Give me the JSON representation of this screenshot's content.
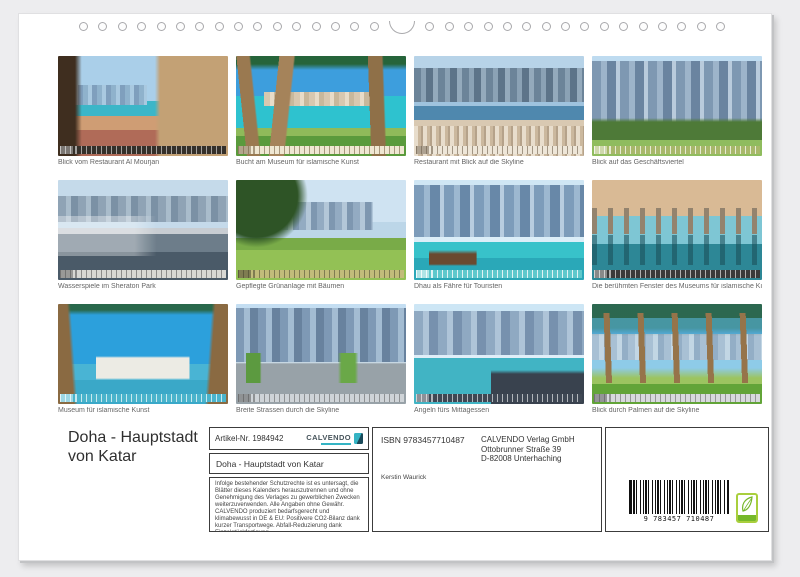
{
  "page": {
    "title_lines": [
      "Doha - Hauptstadt",
      "von Katar"
    ]
  },
  "thumbnails": [
    {
      "caption": "Blick vom Restaurant Al Mourjan"
    },
    {
      "caption": "Bucht am Museum für islamische Kunst"
    },
    {
      "caption": "Restaurant mit Blick auf die Skyline"
    },
    {
      "caption": "Blick auf das Geschäftsviertel"
    },
    {
      "caption": "Wasserspiele im Sheraton Park"
    },
    {
      "caption": "Gepflegte Grünanlage mit Bäumen"
    },
    {
      "caption": "Dhau als Fähre für Touristen"
    },
    {
      "caption": "Die berühmten Fenster des Museums für islamische Kunst"
    },
    {
      "caption": "Museum für islamische Kunst"
    },
    {
      "caption": "Breite Strassen durch die Skyline"
    },
    {
      "caption": "Angeln fürs Mittagessen"
    },
    {
      "caption": "Blick durch Palmen auf die Skyline"
    }
  ],
  "info": {
    "article_number": "Artikel-Nr. 1984942",
    "logo_brand": "CALVENDO",
    "product_title": "Doha - Hauptstadt von Katar",
    "legal_text": "Infolge bestehender Schutzrechte ist es untersagt, die Blätter dieses Kalenders herauszutrennen und ohne Genehmigung des Verlages zu gewerblichen Zwecken weiterzuverwenden. Alle Angaben ohne Gewähr. CALVENDO produziert bedarfsgerecht und klimabewusst in DE & EU: Positivere CO2-Bilanz dank kurzer Transportwege. Abfall-Reduzierung dank Einzelstückfertigung.",
    "contact_line": "E-Mail: info@calvendo.com • www.calvendo.com",
    "isbn": "ISBN 9783457710487",
    "publisher_lines": [
      "CALVENDO Verlag GmbH",
      "Ottobrunner Straße 39",
      "D-82008 Unterhaching"
    ],
    "author": "Kerstin Waurick",
    "barcode_digits": "9 783457 710487"
  },
  "colors": {
    "accent_teal": "#35b4c4",
    "eco_green": "#76b82a",
    "page_background": "#ffffff",
    "backdrop": "#ededef"
  }
}
